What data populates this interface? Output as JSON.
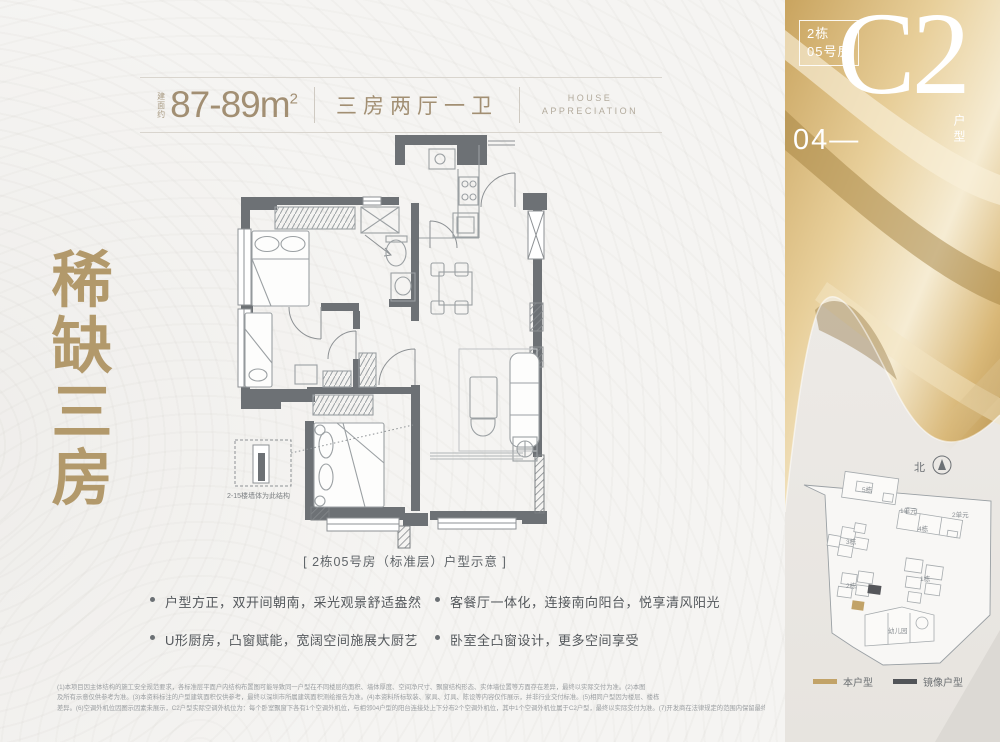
{
  "header": {
    "area_label": "建面约",
    "area_value": "87-89",
    "area_unit": "m",
    "area_sup": "2",
    "layout": "三房两厅一卫",
    "house_line1": "HOUSE",
    "house_line2": "APPRECIATION"
  },
  "side_title": {
    "chars": [
      "稀",
      "缺",
      "三",
      "房"
    ]
  },
  "floorplan": {
    "note": "2-15楼墙体为此结构",
    "caption": "[ 2栋05号房（标准层）户型示意 ]"
  },
  "bullets": [
    "户型方正，双开间朝南，采光观景舒适盎然",
    "U形厨房，凸窗赋能，宽阔空间施展大厨艺",
    "客餐厅一体化，连接南向阳台，悦享清风阳光",
    "卧室全凸窗设计，更多空间享受"
  ],
  "disclaimer": [
    "(1)本项目因主体结构的施工安全规范要求，各标准层平面户内结构布置图可能导致同一户型在不同楼层的面积、墙体厚度、空间净尺寸、飘窗结构形态、实体墙位置等方面存在差异，最终以实际交付为准。(2)本图",
    "及所有示意仅供参考为准。(3)本资料标注的户型建筑面积仅供参考，最终以深圳市所属建筑面积测绘报告为准。(4)本资料所标软装、家具、灯具、陈设等内容仅作展示，并非行业交付标准。(5)相同户型因为楼层、楼栋",
    "差异。(6)空调外机位因图示因素未展示，C2户型实际空调外机位为：每个卧室飘窗下各有1个空调外机位，与相邻04户型的阳台连接处上下分布2个空调外机位，其中1个空调外机位属于C2户型，最终以实际交付为准。(7)开发商在法律规定的范围内保留最终解释权，制作日期2024年11月。"
  ],
  "badge": {
    "block": "2栋",
    "room": "05号房",
    "floor_label": "04—",
    "type_code": "C2",
    "type_suffix": "户型"
  },
  "siteplan": {
    "compass_label": "北",
    "buildings": {
      "b5": "5栋",
      "b3": "3栋",
      "b4": "4栋",
      "u1": "1单元",
      "u2": "2单元",
      "b1": "1栋",
      "b2": "2栋",
      "kg": "幼儿园"
    },
    "legend": [
      {
        "label": "本户型",
        "color": "#c2a368"
      },
      {
        "label": "镜像户型",
        "color": "#515458"
      }
    ]
  },
  "colors": {
    "accent_gold": "#b2996b",
    "wall": "#6d7175",
    "header_text": "#a28f73"
  }
}
